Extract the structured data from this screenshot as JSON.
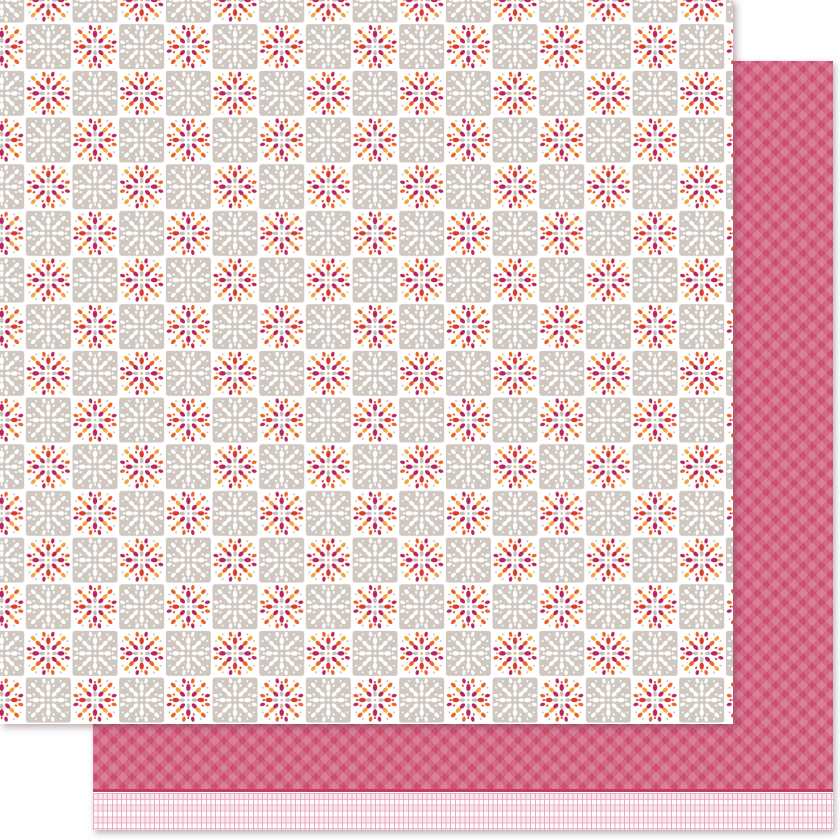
{
  "product": {
    "front_sheet": {
      "pattern_name": "petal patchwork checkerboard",
      "square_size_px": 46.67,
      "colors": {
        "white": "#ffffff",
        "taupe": "#cfc7c0",
        "gray_petal": "#c7bfb8",
        "magenta": "#b8255f",
        "red": "#d93b2b",
        "orange": "#e8622a",
        "amber": "#f2a43e"
      }
    },
    "back_sheet": {
      "pattern_name": "diagonal gingham with plaid border strip",
      "colors": {
        "pink_base": "#cb4a6f",
        "pink_stripe_light": "#d96b8a",
        "separator": "#c23e66",
        "strip_background": "#ffffff",
        "strip_line": "#edb7c7",
        "strip_tint": "#fae7ee"
      }
    },
    "page_background": "#ffffff"
  }
}
